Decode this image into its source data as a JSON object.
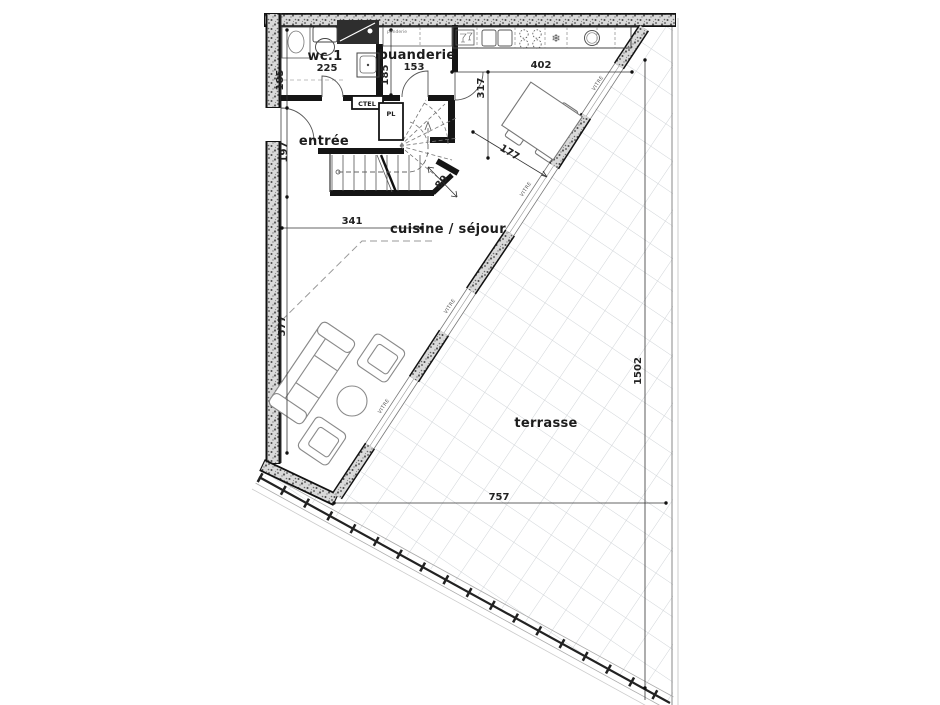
{
  "plan": {
    "rooms": {
      "wc": {
        "label": "wc.1",
        "area": "225"
      },
      "buanderie": {
        "label": "buanderie",
        "area": "153"
      },
      "entree": {
        "label": "entrée"
      },
      "sejour": {
        "label": "cuisine / séjour"
      },
      "terrasse": {
        "label": "terrasse"
      }
    },
    "closets": {
      "ctel": "CTEL",
      "pl": "PL"
    },
    "notes": {
      "counter_note": "penderie"
    },
    "glazing": {
      "label": "VITRE"
    },
    "icons": {
      "snowflake": "❄"
    },
    "dimensions": {
      "wc_height": "185",
      "buanderie_height": "185",
      "entree_height": "197",
      "kitchen_depth": "317",
      "kitchen_width": "402",
      "sejour_width": "341",
      "stair_width": "89",
      "table_clearance": "177",
      "sejour_height": "577",
      "terrasse_height": "1502",
      "terrasse_width": "757"
    },
    "colors": {
      "wall_fill": "#d9d9d9",
      "wall_speckle": "#4a4a4a",
      "solid_wall": "#151515",
      "tile_line": "#d0d4d8",
      "dim_line": "#333333"
    }
  }
}
